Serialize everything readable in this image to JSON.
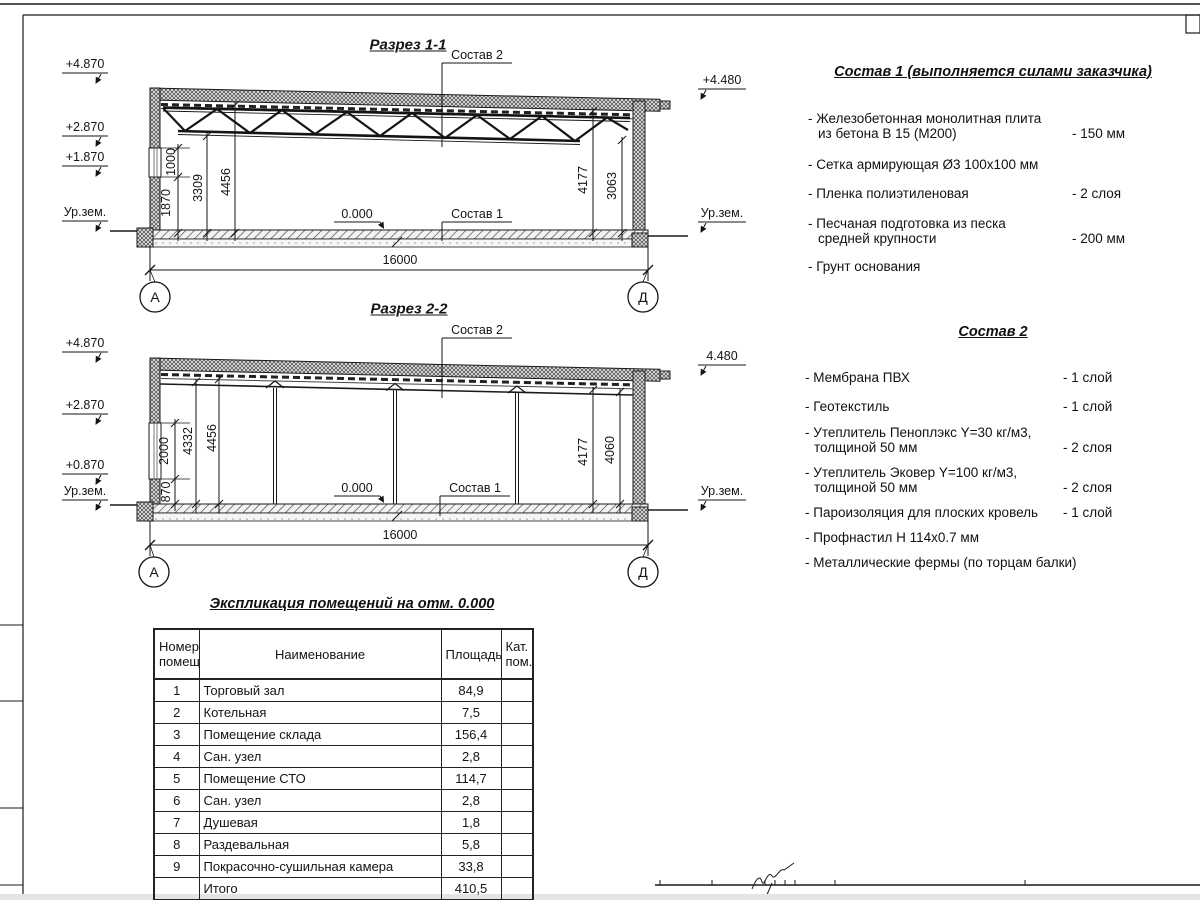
{
  "section1": {
    "title": "Разрез 1-1",
    "elev_left": [
      "+4.870",
      "+2.870",
      "+1.870",
      "Ур.зем."
    ],
    "elev_right": [
      "+4.480",
      "Ур.зем."
    ],
    "dim_1870": "1870",
    "dim_1000": "1000",
    "dim_3309": "3309",
    "dim_4456": "4456",
    "dim_4177": "4177",
    "dim_3063": "3063",
    "level_zero": "0.000",
    "span": "16000",
    "leader_sostav1": "Состав 1",
    "leader_sostav2": "Состав 2",
    "axis_a": "А",
    "axis_d": "Д"
  },
  "section2": {
    "title": "Разрез 2-2",
    "elev_left": [
      "+4.870",
      "+2.870",
      "+0.870",
      "Ур.зем."
    ],
    "elev_right": [
      "4.480",
      "Ур.зем."
    ],
    "dim_870": "870",
    "dim_2000": "2000",
    "dim_4332": "4332",
    "dim_4456": "4456",
    "dim_4177": "4177",
    "dim_4060": "4060",
    "level_zero": "0.000",
    "span": "16000",
    "leader_sostav1": "Состав 1",
    "leader_sostav2": "Состав 2",
    "axis_a": "А",
    "axis_d": "Д"
  },
  "sostav1": {
    "title": "Состав 1 (выполняется силами заказчика)",
    "items": [
      {
        "line1": "- Железобетонная  монолитная плита",
        "line2": "из бетона В 15 (М200)",
        "value": "- 150 мм"
      },
      {
        "line1": "- Сетка армирующая Ø3 100х100 мм",
        "line2": "",
        "value": ""
      },
      {
        "line1": "- Пленка полиэтиленовая",
        "line2": "",
        "value": "- 2 слоя"
      },
      {
        "line1": "- Песчаная подготовка из песка",
        "line2": "средней крупности",
        "value": "- 200 мм"
      },
      {
        "line1": "- Грунт основания",
        "line2": "",
        "value": ""
      }
    ]
  },
  "sostav2": {
    "title": "Состав 2",
    "items": [
      {
        "line1": "- Мембрана ПВХ",
        "line2": "",
        "value": "- 1 слой"
      },
      {
        "line1": "- Геотекстиль",
        "line2": "",
        "value": "- 1 слой"
      },
      {
        "line1": "- Утеплитель Пеноплэкс Y=30 кг/м3,",
        "line2": "толщиной 50 мм",
        "value": "- 2 слоя"
      },
      {
        "line1": "- Утеплитель Эковер Y=100 кг/м3,",
        "line2": "толщиной 50 мм",
        "value": "- 2 слоя"
      },
      {
        "line1": "- Пароизоляция для плоских кровель",
        "line2": "",
        "value": "- 1 слой"
      },
      {
        "line1": "- Профнастил Н 114х0.7 мм",
        "line2": "",
        "value": ""
      },
      {
        "line1": "- Металлические фермы (по торцам балки)",
        "line2": "",
        "value": ""
      }
    ]
  },
  "table": {
    "title": "Экспликация помещений на отм. 0.000",
    "col_num_l1": "Номер",
    "col_num_l2": "помещ.",
    "col_name": "Наименование",
    "col_area": "Площадь",
    "col_cat_l1": "Кат.",
    "col_cat_l2": "пом.",
    "rows": [
      {
        "num": "1",
        "name": "Торговый зал",
        "area": "84,9",
        "cat": ""
      },
      {
        "num": "2",
        "name": "Котельная",
        "area": "7,5",
        "cat": ""
      },
      {
        "num": "3",
        "name": "Помещение склада",
        "area": "156,4",
        "cat": ""
      },
      {
        "num": "4",
        "name": "Сан. узел",
        "area": "2,8",
        "cat": ""
      },
      {
        "num": "5",
        "name": "Помещение СТО",
        "area": "114,7",
        "cat": ""
      },
      {
        "num": "6",
        "name": "Сан. узел",
        "area": "2,8",
        "cat": ""
      },
      {
        "num": "7",
        "name": "Душевая",
        "area": "1,8",
        "cat": ""
      },
      {
        "num": "8",
        "name": "Раздевальная",
        "area": "5,8",
        "cat": ""
      },
      {
        "num": "9",
        "name": "Покрасочно-сушильная камера",
        "area": "33,8",
        "cat": ""
      },
      {
        "num": "",
        "name": "Итого",
        "area": "410,5",
        "cat": ""
      }
    ]
  }
}
